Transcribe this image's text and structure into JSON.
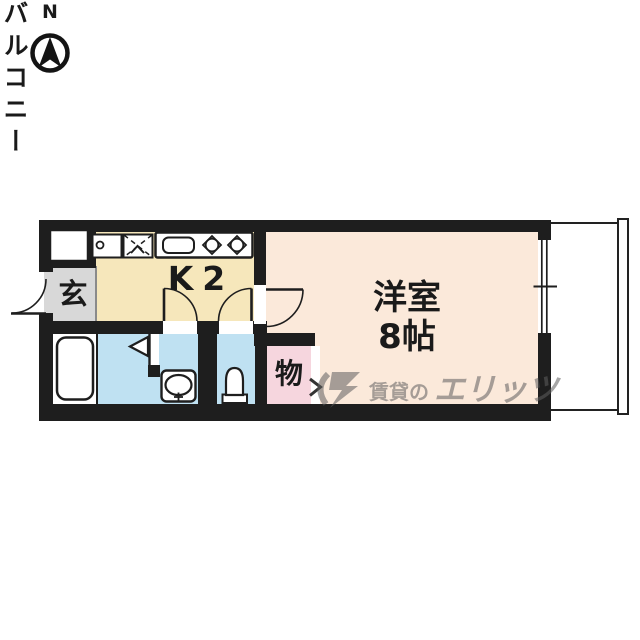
{
  "compass": {
    "north_label": "N"
  },
  "plan": {
    "labels": {
      "entrance": "玄",
      "kitchen": "K2",
      "main_room_line1": "洋室",
      "main_room_line2": "8帖",
      "storage": "物",
      "balcony": "バルコニー"
    },
    "fixtures": [
      "north-compass",
      "entrance-swing-door",
      "pipe-space-box",
      "laundry-space-box",
      "washing-machine-cross-box",
      "kitchen-counter",
      "kitchen-sink",
      "stove-burner",
      "stove-burner",
      "kitchen-swing-door",
      "washroom-swing-door",
      "toilet-swing-door",
      "bathroom-folding-door",
      "bathtub",
      "washbasin",
      "toilet",
      "storage-folding-door-arrow",
      "sliding-window"
    ],
    "colors": {
      "wall": "#1e1e1e",
      "kitchen_floor": "#f6e7bb",
      "main_room_floor": "#fbe9da",
      "wet_area_floor": "#bfe1f2",
      "storage_floor": "#f6d6de",
      "entrance_floor": "#d8d8d8",
      "balcony_floor": "#ffffff"
    }
  },
  "watermark": {
    "prefix": "賃貸の",
    "brand": "エリッツ"
  }
}
